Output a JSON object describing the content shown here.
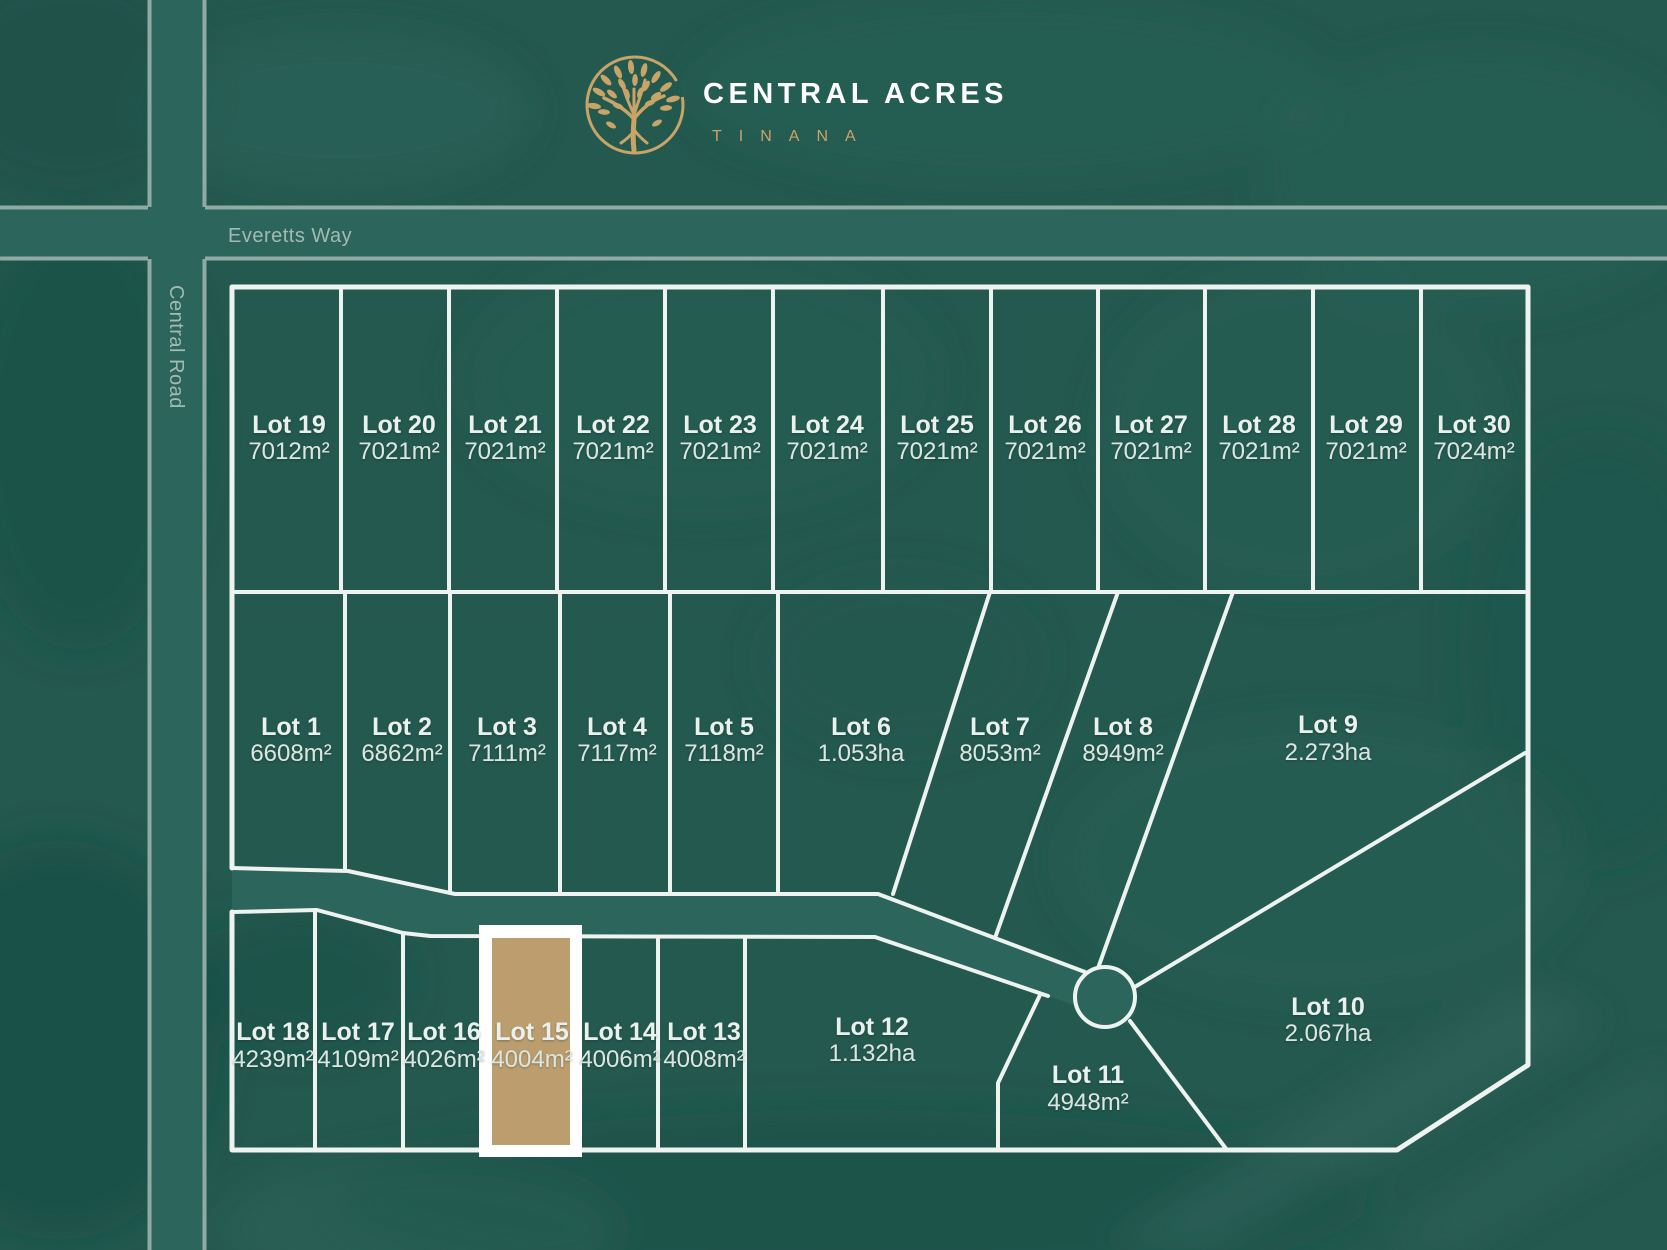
{
  "logo": {
    "title": "CENTRAL ACRES",
    "subtitle": "TINANA",
    "icon": "tree-in-circle-icon"
  },
  "roads": {
    "horizontal": "Everetts Way",
    "vertical": "Central Road"
  },
  "highlighted_lot": "Lot 15",
  "colors": {
    "background": "#24594f",
    "background_dark": "#1b4f47",
    "background_light": "#2d675d",
    "road_fill": "#2c655b",
    "road_edge": "#9db4ad",
    "lot_line": "#eef3ef",
    "lot_label": "#eaf0ed",
    "road_label": "#a3bab3",
    "highlight_fill": "#bb9d6e",
    "highlight_frame": "#ffffff",
    "gold": "#c9a467"
  },
  "lots": [
    {
      "name": "Lot 1",
      "area": "6608m²",
      "highlighted": false
    },
    {
      "name": "Lot 2",
      "area": "6862m²",
      "highlighted": false
    },
    {
      "name": "Lot 3",
      "area": "7111m²",
      "highlighted": false
    },
    {
      "name": "Lot 4",
      "area": "7117m²",
      "highlighted": false
    },
    {
      "name": "Lot 5",
      "area": "7118m²",
      "highlighted": false
    },
    {
      "name": "Lot 6",
      "area": "1.053ha",
      "highlighted": false
    },
    {
      "name": "Lot 7",
      "area": "8053m²",
      "highlighted": false
    },
    {
      "name": "Lot 8",
      "area": "8949m²",
      "highlighted": false
    },
    {
      "name": "Lot 9",
      "area": "2.273ha",
      "highlighted": false
    },
    {
      "name": "Lot 10",
      "area": "2.067ha",
      "highlighted": false
    },
    {
      "name": "Lot 11",
      "area": "4948m²",
      "highlighted": false
    },
    {
      "name": "Lot 12",
      "area": "1.132ha",
      "highlighted": false
    },
    {
      "name": "Lot 13",
      "area": "4008m²",
      "highlighted": false
    },
    {
      "name": "Lot 14",
      "area": "4006m²",
      "highlighted": false
    },
    {
      "name": "Lot 15",
      "area": "4004m²",
      "highlighted": true
    },
    {
      "name": "Lot 16",
      "area": "4026m²",
      "highlighted": false
    },
    {
      "name": "Lot 17",
      "area": "4109m²",
      "highlighted": false
    },
    {
      "name": "Lot 18",
      "area": "4239m²",
      "highlighted": false
    },
    {
      "name": "Lot 19",
      "area": "7012m²",
      "highlighted": false
    },
    {
      "name": "Lot 20",
      "area": "7021m²",
      "highlighted": false
    },
    {
      "name": "Lot 21",
      "area": "7021m²",
      "highlighted": false
    },
    {
      "name": "Lot 22",
      "area": "7021m²",
      "highlighted": false
    },
    {
      "name": "Lot 23",
      "area": "7021m²",
      "highlighted": false
    },
    {
      "name": "Lot 24",
      "area": "7021m²",
      "highlighted": false
    },
    {
      "name": "Lot 25",
      "area": "7021m²",
      "highlighted": false
    },
    {
      "name": "Lot 26",
      "area": "7021m²",
      "highlighted": false
    },
    {
      "name": "Lot 27",
      "area": "7021m²",
      "highlighted": false
    },
    {
      "name": "Lot 28",
      "area": "7021m²",
      "highlighted": false
    },
    {
      "name": "Lot 29",
      "area": "7021m²",
      "highlighted": false
    },
    {
      "name": "Lot 30",
      "area": "7024m²",
      "highlighted": false
    }
  ]
}
